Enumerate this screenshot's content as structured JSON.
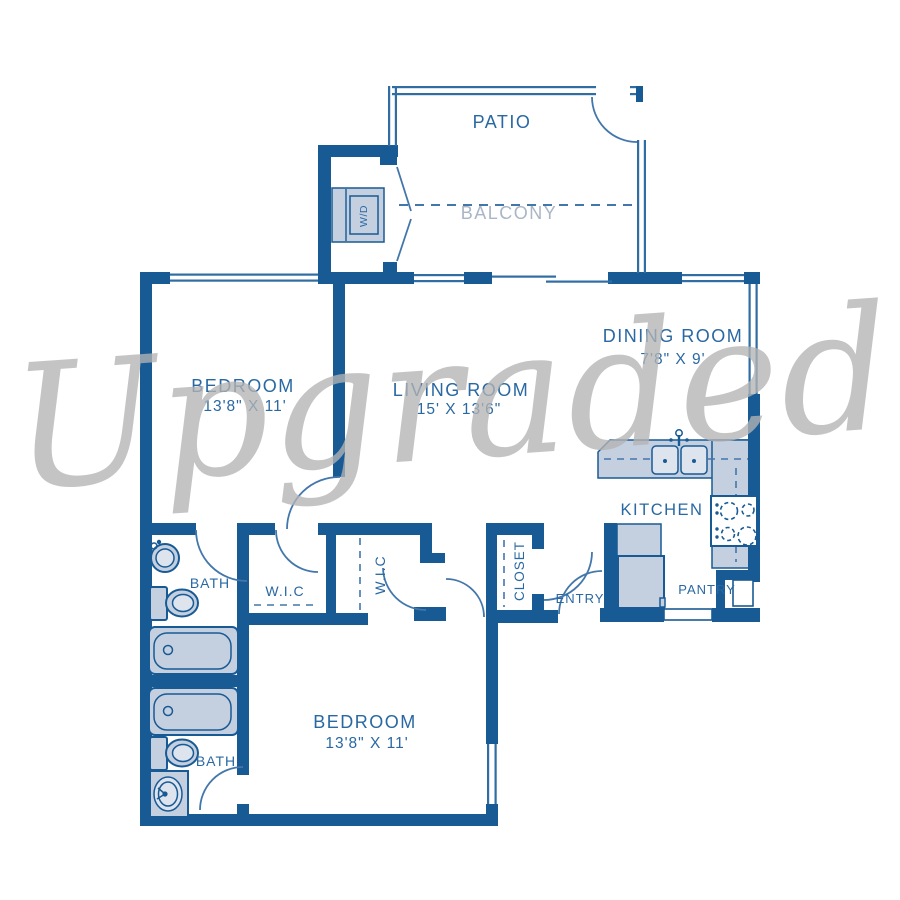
{
  "watermark": "Upgraded",
  "colors": {
    "wall": "#185a94",
    "fixture_fill": "#c4cfe0",
    "fixture_inner": "#dde4ee",
    "label_blue": "#2968a2",
    "balcony_label": "#a9b6c6",
    "door_arc": "#4377ab",
    "watermark_gray": "#b4b4b4"
  },
  "rooms": {
    "patio": {
      "label": "PATIO"
    },
    "balcony": {
      "label": "BALCONY"
    },
    "dining_room": {
      "label": "DINING ROOM",
      "dims": "7'8\" X 9'"
    },
    "living_room": {
      "label": "LIVING ROOM",
      "dims": "15' X 13'6\""
    },
    "bedroom_top": {
      "label": "BEDROOM",
      "dims": "13'8\" X 11'"
    },
    "bedroom_bottom": {
      "label": "BEDROOM",
      "dims": "13'8\" X 11'"
    },
    "kitchen": {
      "label": "KITCHEN"
    },
    "bath_top": {
      "label": "BATH"
    },
    "bath_bottom": {
      "label": "BATH"
    },
    "wic_left": {
      "label": "W.I.C"
    },
    "wic_right": {
      "label": "W.I.C"
    },
    "closet": {
      "label": "CLOSET"
    },
    "entry": {
      "label": "ENTRY"
    },
    "pantry": {
      "label": "PANTRY"
    }
  },
  "appliances": {
    "washer_dryer": "W/D"
  }
}
